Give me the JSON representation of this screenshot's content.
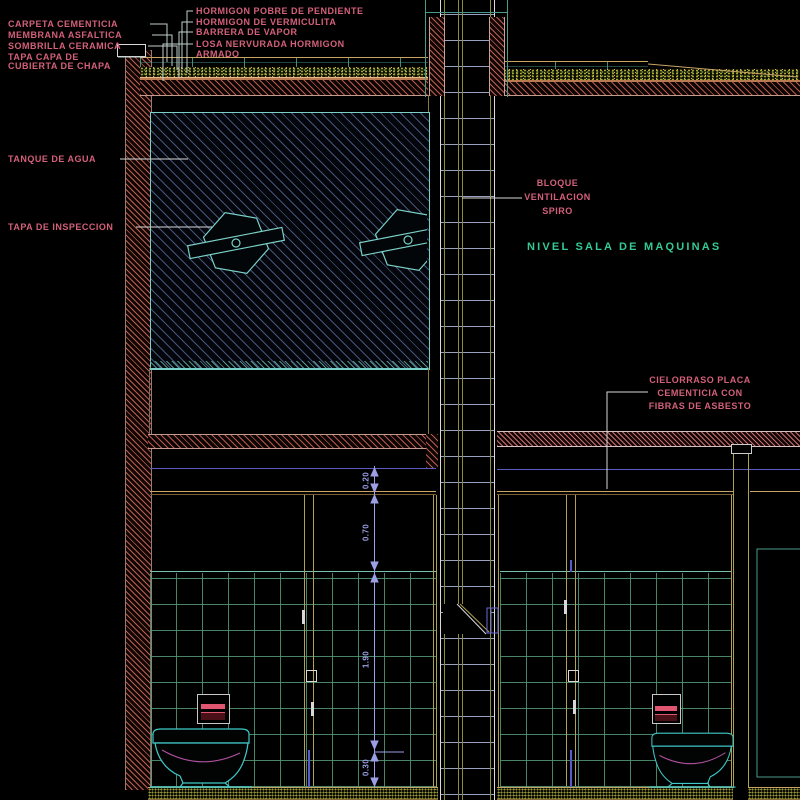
{
  "drawing_title": "Seccion constructiva - tanque de agua, sala de maquinas y sanitarios",
  "labels": {
    "carpeta": "CARPETA CEMENTICIA",
    "membrana": "MEMBRANA ASFALTICA",
    "sombrilla": "SOMBRILLA CERAMICA",
    "tapa_chapa_line1": "TAPA CAPA DE",
    "tapa_chapa_line2": "CUBIERTA DE CHAPA",
    "hormigon_pobre": "HORMIGON POBRE DE PENDIENTE",
    "hormigon_vermiculita": "HORMIGON DE VERMICULITA",
    "barrera_vapor": "BARRERA DE VAPOR",
    "losa_line1": "LOSA NERVURADA HORMIGON",
    "losa_line2": "ARMADO",
    "tanque_agua": "TANQUE DE AGUA",
    "tapa_inspeccion": "TAPA DE INSPECCION",
    "bloque_line1": "BLOQUE",
    "bloque_line2": "VENTILACION",
    "bloque_line3": "SPIRO",
    "nivel_sala": "NIVEL SALA DE MAQUINAS",
    "cielorraso_line1": "CIELORRASO PLACA",
    "cielorraso_line2": "CEMENTICIA CON",
    "cielorraso_line3": "FIBRAS DE ASBESTO"
  },
  "dimensions": {
    "d1": "0.20",
    "d2": "0.70",
    "d3": "1.90",
    "d4": "0.30"
  },
  "colors": {
    "background": "#000000",
    "label_pink": "#d4607a",
    "label_green": "#36c993",
    "dimension_lavender": "#9d9fe6",
    "tank_outline_teal": "#7ad0c8",
    "tile_grid_green": "#559b78",
    "duct_olive": "#8d8d33",
    "wall_hatch_red": "#be5f50",
    "fixture_cyan": "#3fc9c9",
    "accent_pink": "#e05570",
    "line_tan": "#c9a564"
  }
}
